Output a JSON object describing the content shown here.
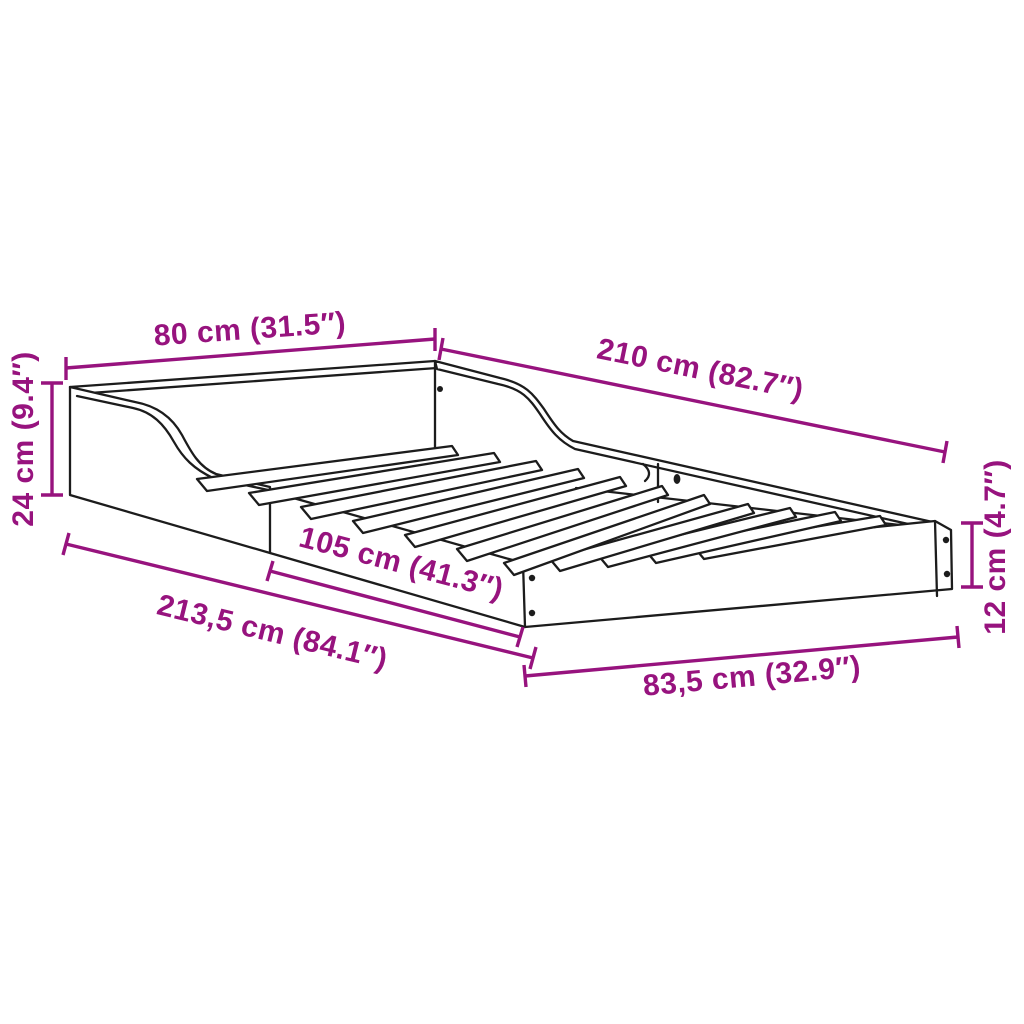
{
  "diagram": {
    "type": "product dimension line drawing",
    "subject": "bed frame with curved side panels and slatted base",
    "background_color": "#ffffff",
    "line_color": "#1c1c1c",
    "dimension_color": "#97137E",
    "dimensions": [
      {
        "id": "head-width",
        "label": "80 cm (31.5″)"
      },
      {
        "id": "side-length",
        "label": "210 cm (82.7″)"
      },
      {
        "id": "head-height",
        "label": "24 cm (9.4″)"
      },
      {
        "id": "mid-length",
        "label": "105 cm (41.3″)"
      },
      {
        "id": "total-length",
        "label": "213,5 cm (84.1″)"
      },
      {
        "id": "foot-width",
        "label": "83,5 cm (32.9″)"
      },
      {
        "id": "foot-height",
        "label": "12 cm (4.7″)"
      }
    ]
  }
}
